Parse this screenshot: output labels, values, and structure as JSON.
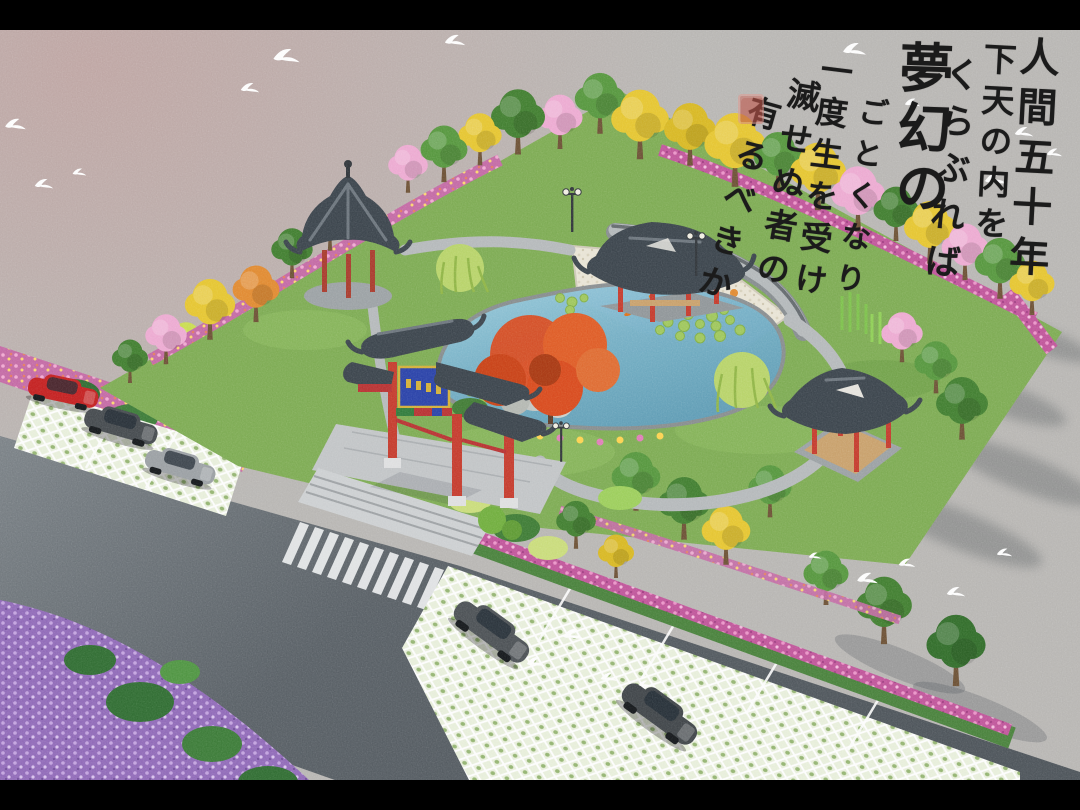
{
  "calligraphy": {
    "columns": [
      "人間五十年",
      "下天の内を",
      "くらぶれば",
      "夢幻の",
      "ごとくなり",
      "一度生を受け",
      "滅せぬ者の",
      "有るべきか"
    ],
    "ink_color": "#1b1b1b",
    "seal_color": "#c0564a"
  },
  "scene": {
    "elements": [
      "paifang-gate",
      "gate-plaque",
      "hexagonal-pavilion",
      "water-pavilion",
      "square-pavilion",
      "lotus-pond",
      "lily-pads",
      "rockery",
      "red-maple",
      "willow-trees",
      "curved-screen-wall",
      "mosaic-plaza",
      "garden-paths",
      "street-lamps",
      "entrance-plaza",
      "entrance-steps",
      "zebra-crossing",
      "asphalt-road",
      "left-parking-grass-grid",
      "bottom-parking-grass-grid",
      "red-car",
      "dark-gray-car",
      "silver-car",
      "dark-car-1",
      "dark-car-2",
      "ginkgo-trees",
      "cherry-blossom-trees",
      "flower-beds",
      "white-doves",
      "red-seal-stamp"
    ]
  },
  "colors": {
    "letterbox": "#000000",
    "background_gray": "#b8b6b3",
    "road": "#565d63",
    "water": "#74b0c8",
    "pavilion_roof": "#39424a",
    "pillar_red": "#c5392b",
    "plaque_blue": "#2840a8",
    "plaque_gold": "#d4af37",
    "lawn_green": "#7cab51",
    "flowers_magenta": "#c05399",
    "flowers_purple": "#8f68b8",
    "ginkgo_yellow": "#e7c62f",
    "maple_red": "#d84a1c"
  }
}
